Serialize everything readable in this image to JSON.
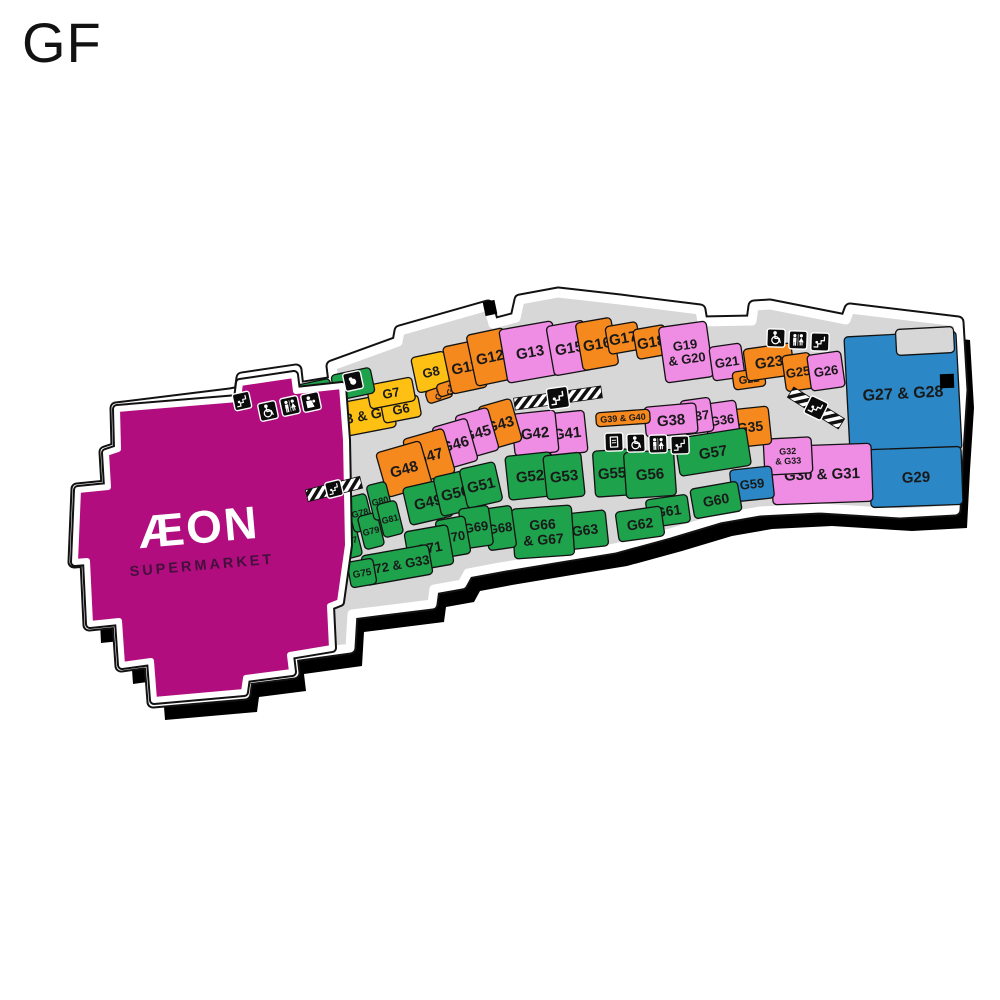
{
  "page": {
    "title": "GF"
  },
  "palette": {
    "magenta": "#b10d7e",
    "orange": "#f6891e",
    "pink": "#ef8ce4",
    "green": "#1ea24c",
    "yellow": "#fdc013",
    "blue": "#2b87c5",
    "corridor": "#d7d7d8",
    "outline": "#121212",
    "label": "#191919",
    "shadow": "#000000",
    "icon_bg": "#0b0b0b",
    "aeon_text": "#ffffff",
    "aeon_sub": "#43103c"
  },
  "map": {
    "shadow_offset": [
      12,
      18
    ],
    "footprint": [
      [
        230,
        394
      ],
      [
        240,
        392
      ],
      [
        242,
        378
      ],
      [
        296,
        370
      ],
      [
        298,
        388
      ],
      [
        334,
        382
      ],
      [
        332,
        366
      ],
      [
        398,
        342
      ],
      [
        400,
        331
      ],
      [
        488,
        306
      ],
      [
        493,
        324
      ],
      [
        516,
        318
      ],
      [
        520,
        300
      ],
      [
        558,
        293
      ],
      [
        620,
        300
      ],
      [
        700,
        310
      ],
      [
        702,
        322
      ],
      [
        752,
        321
      ],
      [
        754,
        306
      ],
      [
        770,
        305
      ],
      [
        846,
        320
      ],
      [
        850,
        309
      ],
      [
        958,
        322
      ],
      [
        962,
        390
      ],
      [
        958,
        452
      ],
      [
        955,
        510
      ],
      [
        900,
        513
      ],
      [
        820,
        508
      ],
      [
        760,
        511
      ],
      [
        720,
        518
      ],
      [
        670,
        533
      ],
      [
        615,
        548
      ],
      [
        560,
        557
      ],
      [
        500,
        567
      ],
      [
        468,
        573
      ],
      [
        462,
        584
      ],
      [
        434,
        589
      ],
      [
        432,
        604
      ],
      [
        352,
        614
      ],
      [
        350,
        648
      ],
      [
        292,
        656
      ],
      [
        294,
        673
      ],
      [
        247,
        679
      ],
      [
        245,
        694
      ],
      [
        153,
        702
      ],
      [
        150,
        662
      ],
      [
        121,
        666
      ],
      [
        118,
        622
      ],
      [
        89,
        625
      ],
      [
        86,
        561
      ],
      [
        74,
        562
      ],
      [
        77,
        489
      ],
      [
        107,
        486
      ],
      [
        105,
        452
      ],
      [
        117,
        448
      ],
      [
        116,
        408
      ]
    ],
    "aeon": {
      "points": [
        [
          117,
          409
        ],
        [
          238,
          399
        ],
        [
          240,
          383
        ],
        [
          294,
          375
        ],
        [
          296,
          391
        ],
        [
          342,
          386
        ],
        [
          346,
          440
        ],
        [
          348,
          545
        ],
        [
          340,
          602
        ],
        [
          330,
          606
        ],
        [
          332,
          648
        ],
        [
          290,
          655
        ],
        [
          292,
          672
        ],
        [
          246,
          678
        ],
        [
          244,
          692
        ],
        [
          154,
          700
        ],
        [
          151,
          661
        ],
        [
          122,
          665
        ],
        [
          119,
          621
        ],
        [
          90,
          624
        ],
        [
          87,
          561
        ],
        [
          75,
          562
        ],
        [
          78,
          490
        ],
        [
          108,
          487
        ],
        [
          106,
          453
        ],
        [
          118,
          449
        ]
      ],
      "label": "ÆON",
      "sublabel": "SUPERMARKET",
      "cx": 200,
      "cy": 543,
      "angle": -5
    },
    "units": [
      {
        "id": "G1",
        "label": "G1",
        "color": "orange",
        "cx": 288,
        "cy": 429,
        "w": 46,
        "h": 36,
        "a": -12
      },
      {
        "id": "G2",
        "label": "G2",
        "color": "green",
        "cx": 317,
        "cy": 417,
        "w": 34,
        "h": 40,
        "a": -12
      },
      {
        "id": "G3-G5",
        "label": "G3 & G5",
        "color": "yellow",
        "cx": 362,
        "cy": 416,
        "w": 64,
        "h": 34,
        "a": -11,
        "fs": 14
      },
      {
        "id": "G6",
        "label": "G6",
        "color": "yellow",
        "cx": 401,
        "cy": 409,
        "w": 38,
        "h": 22,
        "a": -11,
        "fs": 13
      },
      {
        "id": "G7",
        "label": "G7",
        "color": "yellow",
        "cx": 391,
        "cy": 393,
        "w": 46,
        "h": 24,
        "a": -11,
        "fs": 13
      },
      {
        "id": "block-a",
        "label": "",
        "color": "green",
        "cx": 313,
        "cy": 393,
        "w": 38,
        "h": 22,
        "a": -12
      },
      {
        "id": "block-b",
        "label": "",
        "color": "green",
        "cx": 353,
        "cy": 384,
        "w": 40,
        "h": 26,
        "a": -12
      },
      {
        "id": "G8",
        "label": "G8",
        "color": "yellow",
        "cx": 431,
        "cy": 372,
        "w": 34,
        "h": 36,
        "a": -12,
        "fs": 13
      },
      {
        "id": "G9",
        "label": "G9",
        "color": "orange",
        "cx": 439,
        "cy": 394,
        "w": 26,
        "h": 13,
        "a": -18,
        "fs": 9,
        "la": -62
      },
      {
        "id": "G10",
        "label": "G10",
        "color": "orange",
        "cx": 451,
        "cy": 387,
        "w": 28,
        "h": 13,
        "a": -18,
        "fs": 9,
        "la": -62
      },
      {
        "id": "G11",
        "label": "G11",
        "color": "orange",
        "cx": 465,
        "cy": 367,
        "w": 36,
        "h": 48,
        "a": -12
      },
      {
        "id": "G12",
        "label": "G12",
        "color": "orange",
        "cx": 490,
        "cy": 357,
        "w": 38,
        "h": 52,
        "a": -12
      },
      {
        "id": "G13",
        "label": "G13",
        "color": "pink",
        "cx": 530,
        "cy": 352,
        "w": 54,
        "h": 54,
        "a": -10
      },
      {
        "id": "G15",
        "label": "G15",
        "color": "pink",
        "cx": 569,
        "cy": 348,
        "w": 38,
        "h": 50,
        "a": -10
      },
      {
        "id": "G16",
        "label": "G16",
        "color": "orange",
        "cx": 597,
        "cy": 344,
        "w": 36,
        "h": 48,
        "a": -10
      },
      {
        "id": "G17",
        "label": "G17",
        "color": "orange",
        "cx": 623,
        "cy": 338,
        "w": 32,
        "h": 28,
        "a": -10
      },
      {
        "id": "G18",
        "label": "G18",
        "color": "orange",
        "cx": 651,
        "cy": 342,
        "w": 32,
        "h": 30,
        "a": -10
      },
      {
        "id": "G19-G20",
        "label": "G19 & G20",
        "color": "pink",
        "cx": 686,
        "cy": 352,
        "w": 48,
        "h": 56,
        "a": -8,
        "fs": 13,
        "lines": [
          "G19",
          "& G20"
        ]
      },
      {
        "id": "G21",
        "label": "G21",
        "color": "pink",
        "cx": 727,
        "cy": 362,
        "w": 32,
        "h": 34,
        "a": -8,
        "fs": 13
      },
      {
        "id": "G22",
        "label": "G22",
        "color": "orange",
        "cx": 749,
        "cy": 379,
        "w": 32,
        "h": 18,
        "a": -8,
        "fs": 11
      },
      {
        "id": "G23",
        "label": "G23",
        "color": "orange",
        "cx": 769,
        "cy": 362,
        "w": 48,
        "h": 32,
        "a": -8
      },
      {
        "id": "G25",
        "label": "G25",
        "color": "orange",
        "cx": 798,
        "cy": 372,
        "w": 28,
        "h": 36,
        "a": -8,
        "fs": 13
      },
      {
        "id": "G26",
        "label": "G26",
        "color": "pink",
        "cx": 826,
        "cy": 371,
        "w": 34,
        "h": 36,
        "a": -8,
        "fs": 13
      },
      {
        "id": "G27-G28",
        "label": "G27 & G28",
        "color": "blue",
        "cx": 903,
        "cy": 393,
        "w": 112,
        "h": 118,
        "a": -3,
        "fs": 16
      },
      {
        "id": "notch",
        "label": "",
        "color": "corridor",
        "cx": 925,
        "cy": 341,
        "w": 58,
        "h": 26,
        "a": -3
      },
      {
        "id": "G29",
        "label": "G29",
        "color": "blue",
        "cx": 916,
        "cy": 477,
        "w": 92,
        "h": 58,
        "a": -2
      },
      {
        "id": "G30-G31",
        "label": "G30 & G31",
        "color": "pink",
        "cx": 822,
        "cy": 474,
        "w": 100,
        "h": 58,
        "a": -2,
        "fs": 15
      },
      {
        "id": "G32-G33",
        "label": "G32 & G33",
        "color": "pink",
        "cx": 788,
        "cy": 456,
        "w": 48,
        "h": 36,
        "a": -3,
        "fs": 9,
        "lines": [
          "G32",
          "& G33"
        ]
      },
      {
        "id": "G35",
        "label": "G35",
        "color": "orange",
        "cx": 750,
        "cy": 427,
        "w": 40,
        "h": 38,
        "a": -6,
        "fs": 14
      },
      {
        "id": "G36",
        "label": "G36",
        "color": "pink",
        "cx": 722,
        "cy": 420,
        "w": 32,
        "h": 36,
        "a": -8,
        "fs": 13
      },
      {
        "id": "G37",
        "label": "G37",
        "color": "pink",
        "cx": 697,
        "cy": 416,
        "w": 30,
        "h": 34,
        "a": -8,
        "fs": 13
      },
      {
        "id": "G38",
        "label": "G38",
        "color": "pink",
        "cx": 671,
        "cy": 420,
        "w": 52,
        "h": 30,
        "a": -5
      },
      {
        "id": "G39-G40",
        "label": "G39 & G40",
        "color": "orange",
        "cx": 623,
        "cy": 418,
        "w": 54,
        "h": 14,
        "a": -4,
        "fs": 9
      },
      {
        "id": "G41",
        "label": "G41",
        "color": "pink",
        "cx": 567,
        "cy": 433,
        "w": 38,
        "h": 42,
        "a": -6
      },
      {
        "id": "G42",
        "label": "G42",
        "color": "pink",
        "cx": 535,
        "cy": 433,
        "w": 44,
        "h": 42,
        "a": -6
      },
      {
        "id": "G43",
        "label": "G43",
        "color": "orange",
        "cx": 500,
        "cy": 424,
        "w": 34,
        "h": 44,
        "a": -16
      },
      {
        "id": "G45",
        "label": "G45",
        "color": "pink",
        "cx": 477,
        "cy": 433,
        "w": 34,
        "h": 44,
        "a": -16
      },
      {
        "id": "G46",
        "label": "G46",
        "color": "pink",
        "cx": 455,
        "cy": 444,
        "w": 36,
        "h": 44,
        "a": -16
      },
      {
        "id": "G47",
        "label": "G47",
        "color": "orange",
        "cx": 429,
        "cy": 456,
        "w": 42,
        "h": 46,
        "a": -16
      },
      {
        "id": "G48",
        "label": "G48",
        "color": "orange",
        "cx": 404,
        "cy": 469,
        "w": 46,
        "h": 46,
        "a": -16
      },
      {
        "id": "G49",
        "label": "G49",
        "color": "green",
        "cx": 428,
        "cy": 502,
        "w": 44,
        "h": 38,
        "a": -13
      },
      {
        "id": "G50",
        "label": "G50",
        "color": "green",
        "cx": 455,
        "cy": 493,
        "w": 36,
        "h": 40,
        "a": -13
      },
      {
        "id": "G51",
        "label": "G51",
        "color": "green",
        "cx": 481,
        "cy": 485,
        "w": 36,
        "h": 40,
        "a": -13
      },
      {
        "id": "G52",
        "label": "G52",
        "color": "green",
        "cx": 530,
        "cy": 476,
        "w": 46,
        "h": 44,
        "a": -6
      },
      {
        "id": "G53",
        "label": "G53",
        "color": "green",
        "cx": 564,
        "cy": 476,
        "w": 38,
        "h": 44,
        "a": -6
      },
      {
        "id": "G55",
        "label": "G55",
        "color": "green",
        "cx": 612,
        "cy": 473,
        "w": 36,
        "h": 46,
        "a": -4
      },
      {
        "id": "G56",
        "label": "G56",
        "color": "green",
        "cx": 650,
        "cy": 474,
        "w": 50,
        "h": 46,
        "a": -4
      },
      {
        "id": "G57",
        "label": "G57",
        "color": "green",
        "cx": 713,
        "cy": 452,
        "w": 72,
        "h": 38,
        "a": -9
      },
      {
        "id": "G59",
        "label": "G59",
        "color": "blue",
        "cx": 752,
        "cy": 484,
        "w": 42,
        "h": 32,
        "a": -6,
        "fs": 13
      },
      {
        "id": "G60",
        "label": "G60",
        "color": "green",
        "cx": 716,
        "cy": 500,
        "w": 48,
        "h": 30,
        "a": -10,
        "fs": 14
      },
      {
        "id": "G61",
        "label": "G61",
        "color": "green",
        "cx": 668,
        "cy": 511,
        "w": 42,
        "h": 28,
        "a": -8,
        "fs": 14
      },
      {
        "id": "G62",
        "label": "G62",
        "color": "green",
        "cx": 640,
        "cy": 524,
        "w": 46,
        "h": 30,
        "a": -8,
        "fs": 14
      },
      {
        "id": "G63",
        "label": "G63",
        "color": "green",
        "cx": 585,
        "cy": 530,
        "w": 44,
        "h": 36,
        "a": -6,
        "fs": 14
      },
      {
        "id": "G66-G67",
        "label": "G66 & G67",
        "color": "green",
        "cx": 543,
        "cy": 532,
        "w": 60,
        "h": 50,
        "a": -4,
        "fs": 14,
        "lines": [
          "G66",
          "& G67"
        ]
      },
      {
        "id": "G68",
        "label": "G68",
        "color": "green",
        "cx": 500,
        "cy": 528,
        "w": 28,
        "h": 42,
        "a": -8,
        "fs": 13
      },
      {
        "id": "G69",
        "label": "G69",
        "color": "green",
        "cx": 476,
        "cy": 527,
        "w": 30,
        "h": 40,
        "a": -8,
        "fs": 13
      },
      {
        "id": "G70",
        "label": "G70",
        "color": "green",
        "cx": 453,
        "cy": 537,
        "w": 30,
        "h": 38,
        "a": -10,
        "fs": 13
      },
      {
        "id": "G71",
        "label": "G71",
        "color": "green",
        "cx": 429,
        "cy": 548,
        "w": 44,
        "h": 40,
        "a": -10,
        "fs": 14
      },
      {
        "id": "G72-G33",
        "label": "G72 & G33",
        "color": "green",
        "cx": 397,
        "cy": 565,
        "w": 68,
        "h": 30,
        "a": -10,
        "fs": 13
      },
      {
        "id": "G75",
        "label": "G75",
        "color": "green",
        "cx": 362,
        "cy": 573,
        "w": 26,
        "h": 26,
        "a": -10,
        "fs": 10
      },
      {
        "id": "G76",
        "label": "G76",
        "color": "green",
        "cx": 336,
        "cy": 523,
        "w": 20,
        "h": 36,
        "a": -14,
        "fs": 9
      },
      {
        "id": "G77",
        "label": "G77",
        "color": "green",
        "cx": 349,
        "cy": 541,
        "w": 20,
        "h": 34,
        "a": -14,
        "fs": 9
      },
      {
        "id": "G78",
        "label": "G78",
        "color": "green",
        "cx": 360,
        "cy": 513,
        "w": 20,
        "h": 36,
        "a": -14,
        "fs": 9
      },
      {
        "id": "G79",
        "label": "G79",
        "color": "green",
        "cx": 371,
        "cy": 531,
        "w": 20,
        "h": 34,
        "a": -14,
        "fs": 9
      },
      {
        "id": "G80",
        "label": "G80",
        "color": "green",
        "cx": 380,
        "cy": 501,
        "w": 20,
        "h": 36,
        "a": -14,
        "fs": 9
      },
      {
        "id": "G81",
        "label": "G81",
        "color": "green",
        "cx": 390,
        "cy": 519,
        "w": 20,
        "h": 34,
        "a": -14,
        "fs": 9
      }
    ],
    "hatches": [
      {
        "x": 558,
        "y": 398,
        "len": 88,
        "a": -8
      },
      {
        "x": 816,
        "y": 408,
        "len": 60,
        "a": 32
      },
      {
        "x": 334,
        "y": 489,
        "len": 56,
        "a": -14
      }
    ],
    "amenities": [
      {
        "type": "escalator",
        "x": 242,
        "y": 401,
        "a": -12,
        "s": 17
      },
      {
        "type": "wheelchair",
        "x": 268,
        "y": 411,
        "a": -12,
        "s": 18
      },
      {
        "type": "toilets",
        "x": 290,
        "y": 406,
        "a": -12,
        "s": 18
      },
      {
        "type": "nursing-room",
        "x": 311,
        "y": 402,
        "a": -12,
        "s": 18
      },
      {
        "type": "nursery",
        "x": 353,
        "y": 381,
        "a": -12,
        "s": 18
      },
      {
        "type": "escalator",
        "x": 558,
        "y": 398,
        "a": -8,
        "s": 21
      },
      {
        "type": "water-fountain",
        "x": 614,
        "y": 442,
        "a": -2,
        "s": 18
      },
      {
        "type": "wheelchair",
        "x": 636,
        "y": 443,
        "a": -2,
        "s": 18
      },
      {
        "type": "toilets",
        "x": 658,
        "y": 444,
        "a": -2,
        "s": 18
      },
      {
        "type": "escalator",
        "x": 680,
        "y": 445,
        "a": -2,
        "s": 18
      },
      {
        "type": "wheelchair",
        "x": 776,
        "y": 338,
        "a": 2,
        "s": 18
      },
      {
        "type": "toilets",
        "x": 798,
        "y": 340,
        "a": 2,
        "s": 18
      },
      {
        "type": "escalator",
        "x": 820,
        "y": 342,
        "a": 2,
        "s": 18
      },
      {
        "type": "escalator",
        "x": 816,
        "y": 408,
        "a": 26,
        "s": 19
      },
      {
        "type": "escalator",
        "x": 334,
        "y": 489,
        "a": -14,
        "s": 16
      }
    ],
    "entrance_marks": [
      {
        "x": 490,
        "y": 308,
        "w": 12,
        "h": 14,
        "a": -12
      },
      {
        "x": 947,
        "y": 381,
        "w": 14,
        "h": 14,
        "a": -2
      }
    ]
  }
}
